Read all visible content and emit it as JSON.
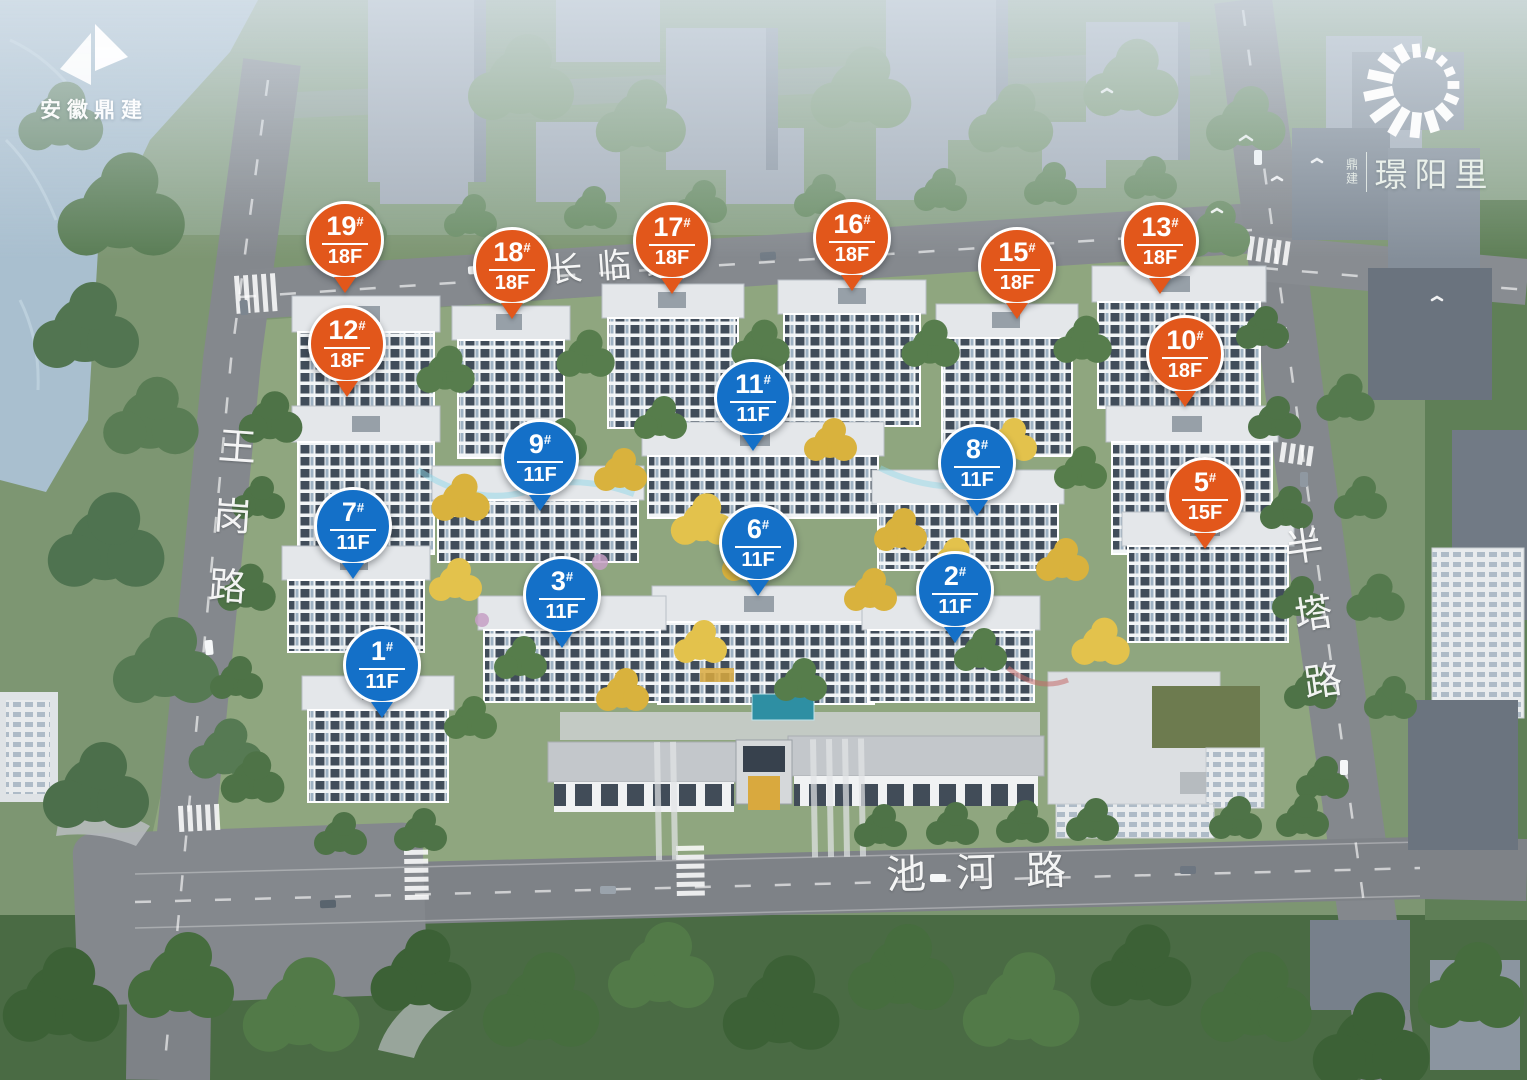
{
  "developer_logo": {
    "name": "安徽鼎建"
  },
  "brand_logo": {
    "prefix": "鼎建",
    "name": "璟阳里"
  },
  "roads": {
    "changlin": "长临路",
    "wanggang": "王岗路",
    "banta": "半塔路",
    "chihe": "池河路"
  },
  "marker_colors": {
    "highrise": "#e2571b",
    "midrise": "#1470c8"
  },
  "markers": [
    {
      "number": "19",
      "hash": "#",
      "floors": "18F",
      "type": "highrise",
      "x": 345,
      "y": 293
    },
    {
      "number": "12",
      "hash": "#",
      "floors": "18F",
      "type": "highrise",
      "x": 347,
      "y": 397
    },
    {
      "number": "18",
      "hash": "#",
      "floors": "18F",
      "type": "highrise",
      "x": 512,
      "y": 319
    },
    {
      "number": "17",
      "hash": "#",
      "floors": "18F",
      "type": "highrise",
      "x": 672,
      "y": 294
    },
    {
      "number": "16",
      "hash": "#",
      "floors": "18F",
      "type": "highrise",
      "x": 852,
      "y": 291
    },
    {
      "number": "15",
      "hash": "#",
      "floors": "18F",
      "type": "highrise",
      "x": 1017,
      "y": 319
    },
    {
      "number": "13",
      "hash": "#",
      "floors": "18F",
      "type": "highrise",
      "x": 1160,
      "y": 294
    },
    {
      "number": "10",
      "hash": "#",
      "floors": "18F",
      "type": "highrise",
      "x": 1185,
      "y": 407
    },
    {
      "number": "11",
      "hash": "#",
      "floors": "11F",
      "type": "midrise",
      "x": 753,
      "y": 451
    },
    {
      "number": "9",
      "hash": "#",
      "floors": "11F",
      "type": "midrise",
      "x": 540,
      "y": 511
    },
    {
      "number": "8",
      "hash": "#",
      "floors": "11F",
      "type": "midrise",
      "x": 977,
      "y": 516
    },
    {
      "number": "7",
      "hash": "#",
      "floors": "11F",
      "type": "midrise",
      "x": 353,
      "y": 579
    },
    {
      "number": "5",
      "hash": "#",
      "floors": "15F",
      "type": "highrise",
      "x": 1205,
      "y": 549
    },
    {
      "number": "6",
      "hash": "#",
      "floors": "11F",
      "type": "midrise",
      "x": 758,
      "y": 596
    },
    {
      "number": "3",
      "hash": "#",
      "floors": "11F",
      "type": "midrise",
      "x": 562,
      "y": 648
    },
    {
      "number": "2",
      "hash": "#",
      "floors": "11F",
      "type": "midrise",
      "x": 955,
      "y": 643
    },
    {
      "number": "1",
      "hash": "#",
      "floors": "11F",
      "type": "midrise",
      "x": 382,
      "y": 718
    }
  ]
}
